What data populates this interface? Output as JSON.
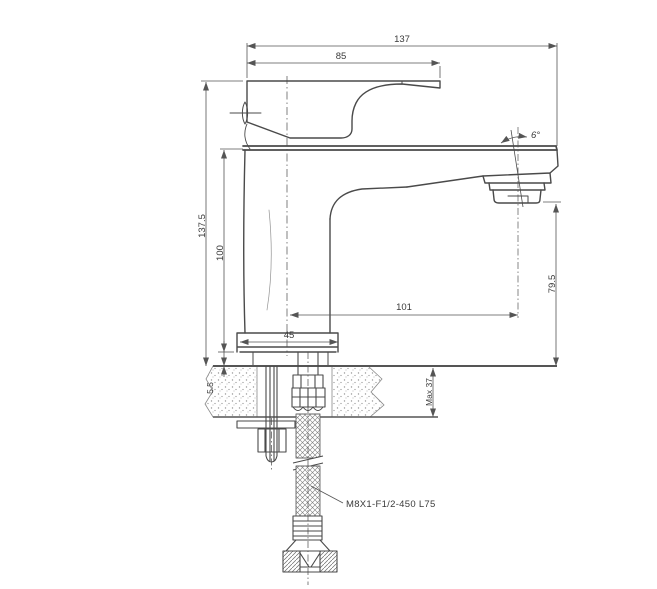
{
  "drawing": {
    "type": "technical-drawing",
    "subject": "single-lever basin mixer faucet, side section view with mounting hardware and flexible supply hose",
    "colors": {
      "background": "#ffffff",
      "outline": "#4a4a4a",
      "dimension": "#555555",
      "text": "#3a3a3a"
    },
    "dimensions": {
      "overall_width": "137",
      "handle_length": "85",
      "overall_height": "137.5",
      "body_height": "100",
      "spout_reach": "101",
      "outlet_height": "79.5",
      "base_width": "45",
      "gasket_thickness": "5.5",
      "max_counter_thickness": "Max 37",
      "spout_angle": "6°",
      "hose_spec": "M8X1-F1/2-450 L75"
    }
  }
}
